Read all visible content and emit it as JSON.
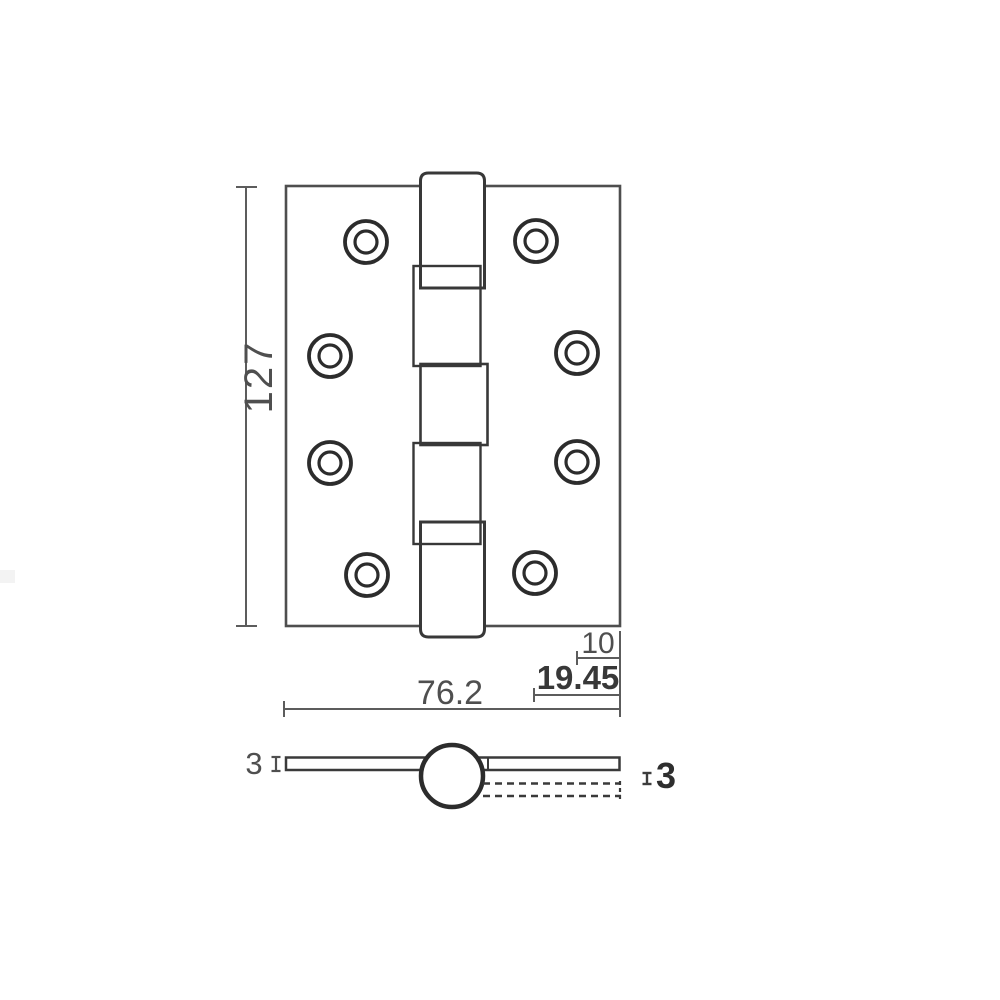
{
  "drawing": {
    "type": "technical-drawing",
    "subject": "door-hinge",
    "front_view": {
      "height_label": "127",
      "width_label": "76.2",
      "pin_offset_label": "10",
      "hole_offset_label": "19.45"
    },
    "section_view": {
      "left_thickness_label": "3",
      "right_thickness_label": "3"
    },
    "colors": {
      "line": "#383838",
      "plate_line": "#4e4e4e",
      "dimension_line": "#5c5c5c",
      "background": "#ffffff"
    }
  }
}
